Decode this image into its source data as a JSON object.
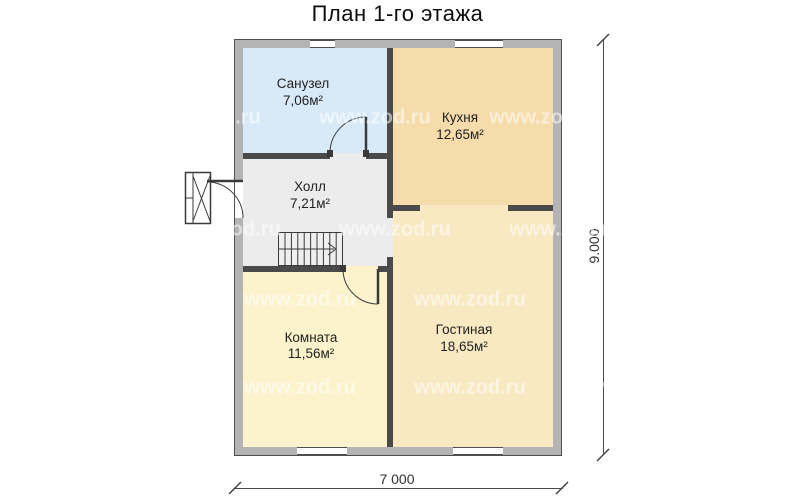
{
  "title": "План 1-го этажа",
  "rooms": [
    {
      "id": "sanuzel",
      "name": "Санузел",
      "area": "7,06м²",
      "color": "#d8eaf8"
    },
    {
      "id": "kitchen",
      "name": "Кухня",
      "area": "12,65м²",
      "color": "#f6dbab"
    },
    {
      "id": "hall",
      "name": "Холл",
      "area": "7,21м²",
      "color": "#ececec"
    },
    {
      "id": "room",
      "name": "Комната",
      "area": "11,56м²",
      "color": "#fcf3cc"
    },
    {
      "id": "living",
      "name": "Гостиная",
      "area": "18,65м²",
      "color": "#f9e9c2"
    }
  ],
  "dimensions": {
    "width_label": "7 000",
    "height_label": "9.000"
  },
  "watermark": "www.zod.ru",
  "colors": {
    "exterior_wall": "#b4b4b4",
    "wall_edge": "#4f4f4f",
    "interior_wall": "#4a4a4a",
    "bathroom_fill": "#d8eaf8",
    "kitchen_fill": "#f6dbab",
    "hall_fill": "#ececec",
    "room_fill": "#fcf3cc",
    "living_fill": "#f9e9c2"
  }
}
